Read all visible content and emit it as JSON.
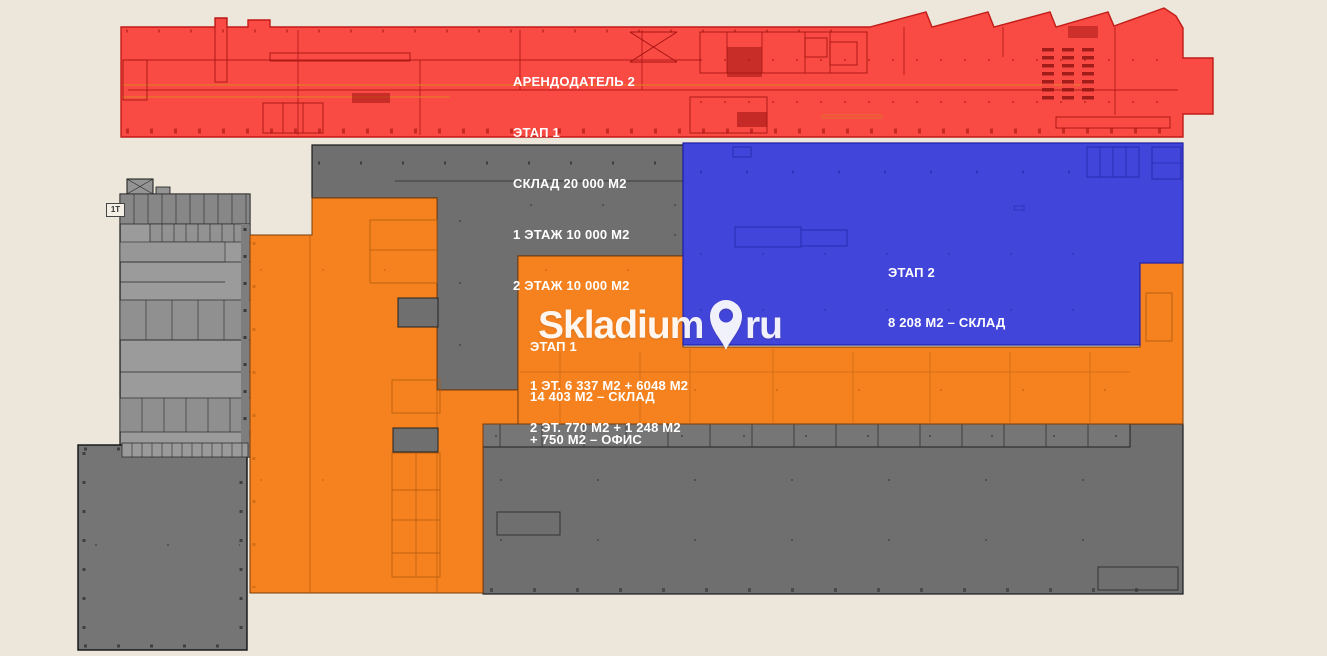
{
  "colors": {
    "background": "#ece7da",
    "red": "#f94a44",
    "blue": "#4245d9",
    "orange": "#f5821f",
    "gray_dark": "#6f6f6f",
    "gray_light": "#9b9b9b",
    "label_text": "#ffffff",
    "watermark": "#ffffff"
  },
  "zones": {
    "landlord2": {
      "color": "#f94a44",
      "lines": [
        "АРЕНДОДАТЕЛЬ 2",
        "ЭТАП 1",
        "СКЛАД 20 000 М2",
        "1 ЭТАЖ 10 000 М2",
        "2 ЭТАЖ 10 000 М2"
      ]
    },
    "stage2": {
      "color": "#4245d9",
      "lines": [
        "ЭТАП 2",
        "8 208 М2 – СКЛАД"
      ]
    },
    "stage1": {
      "color": "#f5821f",
      "lines": [
        "ЭТАП 1",
        "14 403 М2 – СКЛАД",
        "1 ЭТ. 6 337 М2 + 6048 М2",
        "2 ЭТ. 770 М2 + 1 248 М2",
        "+ 750 М2 – ОФИС"
      ]
    }
  },
  "labels": {
    "annex_tag": "1Т"
  },
  "watermark": {
    "brand": "Skladium",
    "tld": "ru"
  }
}
